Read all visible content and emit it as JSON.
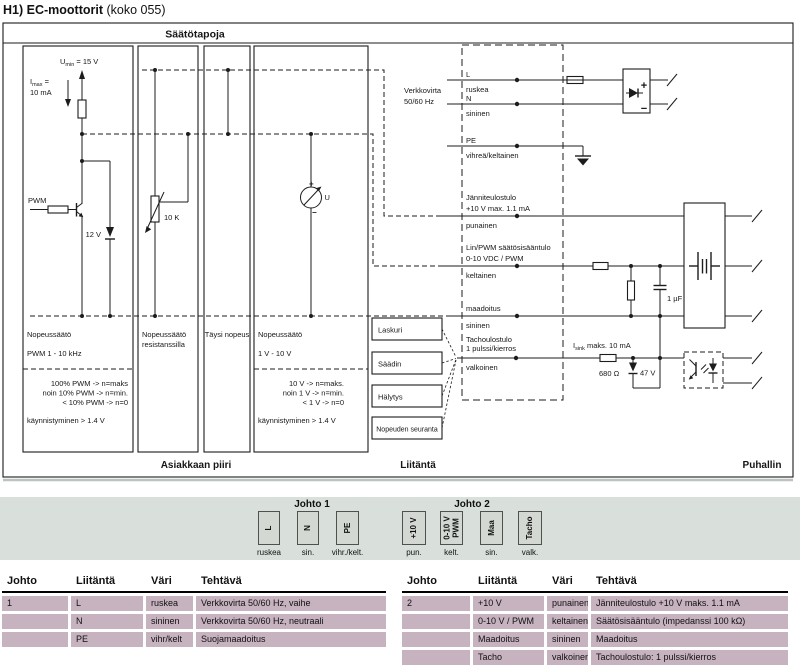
{
  "title": {
    "bold": "H1) EC-moottorit",
    "regular": " (koko 055)"
  },
  "diagram": {
    "header": "Säätötapoja",
    "footer": {
      "customer": "Asiakkaan piiri",
      "interface": "Liitäntä",
      "fan": "Puhallin"
    },
    "panel1": {
      "umin_u": "U",
      "umin_sub": "min",
      "umin_rest": " = 15 V",
      "imax_i": "I",
      "imax_sub": "max",
      "imax_rest": " =",
      "imax_value": "10 mA",
      "pwm_label": "PWM",
      "zener_label": "12 V",
      "caption1": "Nopeussäätö",
      "caption2": "PWM 1 - 10 kHz",
      "note1": "100% PWM -> n=maks",
      "note2": "noin 10% PWM -> n=min.",
      "note3": "< 10% PWM -> n=0",
      "note4": "käynnistyminen > 1.4 V"
    },
    "panel2": {
      "pot_label": "10 K",
      "caption1": "Nopeussäätö",
      "caption2": "resistanssilla"
    },
    "panel3": {
      "caption": "Täysi nopeus"
    },
    "panel4": {
      "meter_label": "U",
      "plus": "+",
      "minus": "−",
      "caption1": "Nopeussäätö",
      "caption2": "1 V - 10 V",
      "note1": "10 V -> n=maks.",
      "note2": "noin 1 V -> n=min.",
      "note3": "< 1 V -> n=0",
      "note4": "käynnistyminen > 1.4 V"
    },
    "mains": {
      "line1": "Verkkovirta",
      "line2": "50/60 Hz"
    },
    "rows": {
      "L": {
        "label": "L",
        "color": "ruskea"
      },
      "N": {
        "label": "N",
        "color": "sininen"
      },
      "PE": {
        "label": "PE",
        "color": "vihreä/keltainen"
      },
      "vout": {
        "label1": "Jänniteulostulo",
        "label2": "+10 V max. 1.1 mA",
        "color": "punainen"
      },
      "ctrl": {
        "label1": "Lin/PWM säätösisääntulo",
        "label2": "0-10 VDC / PWM",
        "color": "keltainen"
      },
      "gnd": {
        "label": "maadoitus",
        "color": "sininen"
      },
      "tacho": {
        "label1": "Tachoulostulo",
        "label2": "1 pulssi/kierros",
        "color": "valkoinen"
      }
    },
    "components": {
      "cap": "1 µF",
      "isink_i": "I",
      "isink_sub": "sink",
      "isink_rest": " maks. 10 mA",
      "res680": "680 Ω",
      "zener47": "47 V",
      "rect_plus": "+",
      "rect_minus": "−"
    },
    "blocks": {
      "laskuri": "Laskuri",
      "saadin": "Säädin",
      "halytys": "Hälytys",
      "nopeuden": "Nopeuden seuranta"
    }
  },
  "band": {
    "johto1": {
      "title": "Johto 1",
      "terminals": [
        {
          "label": "L",
          "color": "ruskea"
        },
        {
          "label": "N",
          "color": "sin."
        },
        {
          "label": "PE",
          "color": "vihr./kelt."
        }
      ]
    },
    "johto2": {
      "title": "Johto 2",
      "terminals": [
        {
          "label": "+10 V",
          "color": "pun."
        },
        {
          "label": "0-10 V",
          "label2": "PWM",
          "color": "kelt."
        },
        {
          "label": "Maa",
          "color": "sin."
        },
        {
          "label": "Tacho",
          "color": "valk."
        }
      ]
    }
  },
  "tables": {
    "headers": [
      "Johto",
      "Liitäntä",
      "Väri",
      "Tehtävä"
    ],
    "table1": {
      "rows": [
        [
          "1",
          "L",
          "ruskea",
          "Verkkovirta 50/60 Hz, vaihe"
        ],
        [
          "",
          "N",
          "sininen",
          "Verkkovirta 50/60 Hz, neutraali"
        ],
        [
          "",
          "PE",
          "vihr/kelt",
          "Suojamaadoitus"
        ]
      ]
    },
    "table2": {
      "rows": [
        [
          "2",
          "+10 V",
          "punainen",
          "Jänniteulostulo +10 V maks. 1.1 mA"
        ],
        [
          "",
          "0-10 V / PWM",
          "keltainen",
          "Säätösisääntulo (impedanssi 100 kΩ)"
        ],
        [
          "",
          "Maadoitus",
          "sininen",
          "Maadoitus"
        ],
        [
          "",
          "Tacho",
          "valkoinen",
          "Tachoulostulo: 1 pulssi/kierros"
        ]
      ]
    }
  },
  "colors": {
    "row_bg": "#c7b2c0",
    "band_bg": "#d9e0db",
    "block_bg": "#d3d8d3",
    "line": "#1c1c1c"
  }
}
